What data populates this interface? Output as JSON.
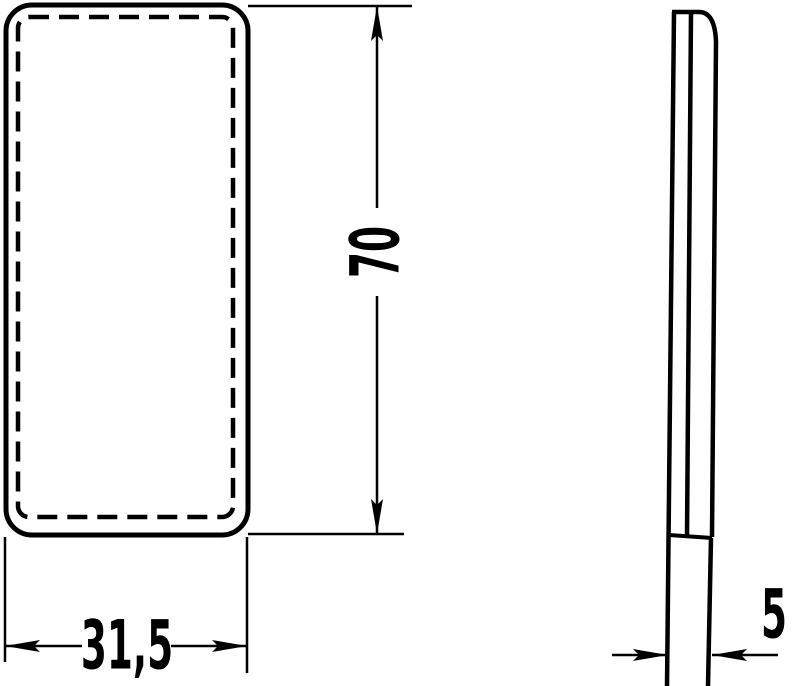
{
  "drawing": {
    "type": "technical-dimension-drawing",
    "views": {
      "front": {
        "shape": "rounded-rectangle",
        "outline": "solid",
        "inner_outline": "dashed"
      },
      "side": {
        "shape": "thin-profile"
      }
    },
    "dimensions": {
      "height": {
        "label": "70",
        "orientation": "vertical"
      },
      "width": {
        "label": "31,5",
        "orientation": "horizontal"
      },
      "depth": {
        "label": "5",
        "orientation": "horizontal"
      }
    },
    "colors": {
      "line": "#000000",
      "background": "#ffffff"
    }
  }
}
